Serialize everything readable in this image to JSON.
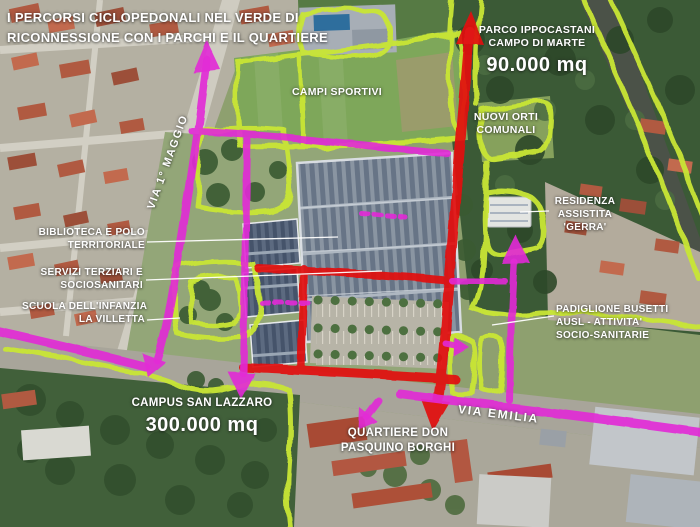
{
  "title": {
    "line1": "I PERCORSI CICLOPEDONALI NEL VERDE DI",
    "line2": "RICONNESSIONE CON I PARCHI E IL QUARTIERE"
  },
  "labels": {
    "parco": {
      "line1": "PARCO IPPOCASTANI",
      "line2": "CAMPO DI MARTE",
      "area": "90.000 mq"
    },
    "campi_sportivi": "CAMPI SPORTIVI",
    "nuovi_orti": {
      "line1": "NUOVI ORTI",
      "line2": "COMUNALI"
    },
    "via_maggio": "VIA 1° MAGGIO",
    "residenza": {
      "line1": "RESIDENZA",
      "line2": "ASSISTITA",
      "line3": "'GERRA'"
    },
    "biblioteca": {
      "line1": "BIBLIOTECA E POLO",
      "line2": "TERRITORIALE"
    },
    "servizi": {
      "line1": "SERVIZI TERZIARI E",
      "line2": "SOCIOSANITARI"
    },
    "scuola": {
      "line1": "SCUOLA DELL'INFANZIA",
      "line2": "LA VILLETTA"
    },
    "padiglione": {
      "line1": "PADIGLIONE BUSETTI",
      "line2": "AUSL - ATTIVITA'",
      "line3": "SOCIO-SANITARIE"
    },
    "campus": {
      "line1": "CAMPUS SAN LAZZARO",
      "area": "300.000 mq"
    },
    "quartiere": {
      "line1": "QUARTIERE DON",
      "line2": "PASQUINO BORGHI"
    },
    "via_emilia": "VIA EMILIA"
  },
  "legend_colors": {
    "cycle_pedestrian_route": "#e32bd6",
    "main_axis_route": "#e21313",
    "green_connection_outline": "#c9e636"
  }
}
